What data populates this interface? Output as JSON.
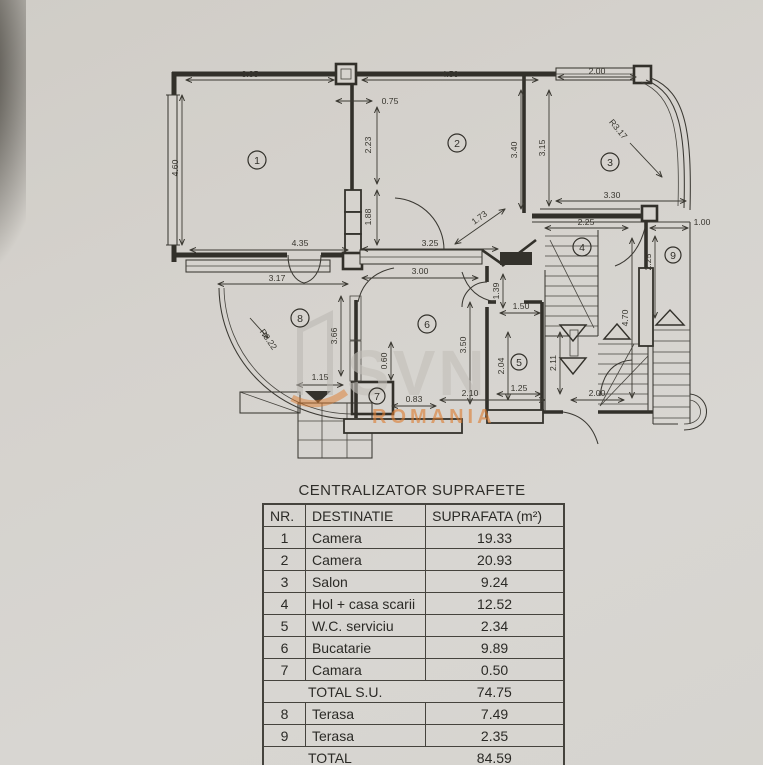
{
  "table": {
    "title": "CENTRALIZATOR SUPRAFETE",
    "headers": [
      "NR.",
      "DESTINATIE",
      "SUPRAFATA (m²)"
    ],
    "rows": [
      {
        "nr": "1",
        "destinatie": "Camera",
        "suprafata": "19.33"
      },
      {
        "nr": "2",
        "destinatie": "Camera",
        "suprafata": "20.93"
      },
      {
        "nr": "3",
        "destinatie": "Salon",
        "suprafata": "9.24"
      },
      {
        "nr": "4",
        "destinatie": "Hol + casa scarii",
        "suprafata": "12.52"
      },
      {
        "nr": "5",
        "destinatie": "W.C. serviciu",
        "suprafata": "2.34"
      },
      {
        "nr": "6",
        "destinatie": "Bucatarie",
        "suprafata": "9.89"
      },
      {
        "nr": "7",
        "destinatie": "Camara",
        "suprafata": "0.50"
      },
      {
        "nr": "",
        "destinatie": "TOTAL S.U.",
        "suprafata": "74.75",
        "total": true
      },
      {
        "nr": "8",
        "destinatie": "Terasa",
        "suprafata": "7.49"
      },
      {
        "nr": "9",
        "destinatie": "Terasa",
        "suprafata": "2.35"
      },
      {
        "nr": "",
        "destinatie": "TOTAL",
        "suprafata": "84.59",
        "total": true
      }
    ]
  },
  "plan": {
    "rooms": [
      {
        "num": "1",
        "x": 257,
        "y": 160,
        "rad": 9
      },
      {
        "num": "2",
        "x": 457,
        "y": 143,
        "rad": 9
      },
      {
        "num": "3",
        "x": 610,
        "y": 162,
        "rad": 9
      },
      {
        "num": "4",
        "x": 582,
        "y": 247,
        "rad": 9
      },
      {
        "num": "5",
        "x": 519,
        "y": 362,
        "rad": 8
      },
      {
        "num": "6",
        "x": 427,
        "y": 324,
        "rad": 9
      },
      {
        "num": "7",
        "x": 377,
        "y": 396,
        "rad": 8
      },
      {
        "num": "8",
        "x": 300,
        "y": 318,
        "rad": 9
      },
      {
        "num": "9",
        "x": 673,
        "y": 255,
        "rad": 8
      }
    ],
    "dimensions": [
      {
        "t": "3.85",
        "x": 250,
        "y": 77
      },
      {
        "t": "4.50",
        "x": 450,
        "y": 77
      },
      {
        "t": "2.00",
        "x": 597,
        "y": 74
      },
      {
        "t": "0.75",
        "x": 390,
        "y": 104
      },
      {
        "t": "2.23",
        "x": 371,
        "y": 145,
        "r": -90
      },
      {
        "t": "1.88",
        "x": 371,
        "y": 217,
        "r": -90
      },
      {
        "t": "4.60",
        "x": 178,
        "y": 168,
        "r": -90
      },
      {
        "t": "3.40",
        "x": 517,
        "y": 150,
        "r": -90
      },
      {
        "t": "3.15",
        "x": 545,
        "y": 148,
        "r": -90
      },
      {
        "t": "R3.17",
        "x": 616,
        "y": 131,
        "r": 50
      },
      {
        "t": "3.30",
        "x": 612,
        "y": 198
      },
      {
        "t": "2.25",
        "x": 586,
        "y": 225
      },
      {
        "t": "1.00",
        "x": 702,
        "y": 225
      },
      {
        "t": "2.25",
        "x": 651,
        "y": 262,
        "r": -90
      },
      {
        "t": "4.70",
        "x": 628,
        "y": 318,
        "r": -90
      },
      {
        "t": "4.35",
        "x": 300,
        "y": 246
      },
      {
        "t": "3.25",
        "x": 430,
        "y": 246
      },
      {
        "t": "1.73",
        "x": 481,
        "y": 220,
        "r": -36
      },
      {
        "t": "3.17",
        "x": 277,
        "y": 281
      },
      {
        "t": "3.00",
        "x": 420,
        "y": 274
      },
      {
        "t": "R3.22",
        "x": 266,
        "y": 341,
        "r": 55
      },
      {
        "t": "3.66",
        "x": 337,
        "y": 336,
        "r": -90
      },
      {
        "t": "3.50",
        "x": 466,
        "y": 345,
        "r": -90
      },
      {
        "t": "1.39",
        "x": 499,
        "y": 291,
        "r": -90
      },
      {
        "t": "1.50",
        "x": 521,
        "y": 309
      },
      {
        "t": "2.04",
        "x": 504,
        "y": 366,
        "r": -90
      },
      {
        "t": "0.60",
        "x": 387,
        "y": 361,
        "r": -90
      },
      {
        "t": "1.15",
        "x": 320,
        "y": 380
      },
      {
        "t": "0.83",
        "x": 414,
        "y": 402
      },
      {
        "t": "2.10",
        "x": 470,
        "y": 396
      },
      {
        "t": "1.25",
        "x": 519,
        "y": 391
      },
      {
        "t": "2.00",
        "x": 597,
        "y": 396
      },
      {
        "t": "2.11",
        "x": 556,
        "y": 363,
        "r": -90
      }
    ],
    "watermark": {
      "logo_text": "SVN",
      "sub_text": "ROMANIA",
      "accent_color": "#dd7b2e"
    }
  }
}
